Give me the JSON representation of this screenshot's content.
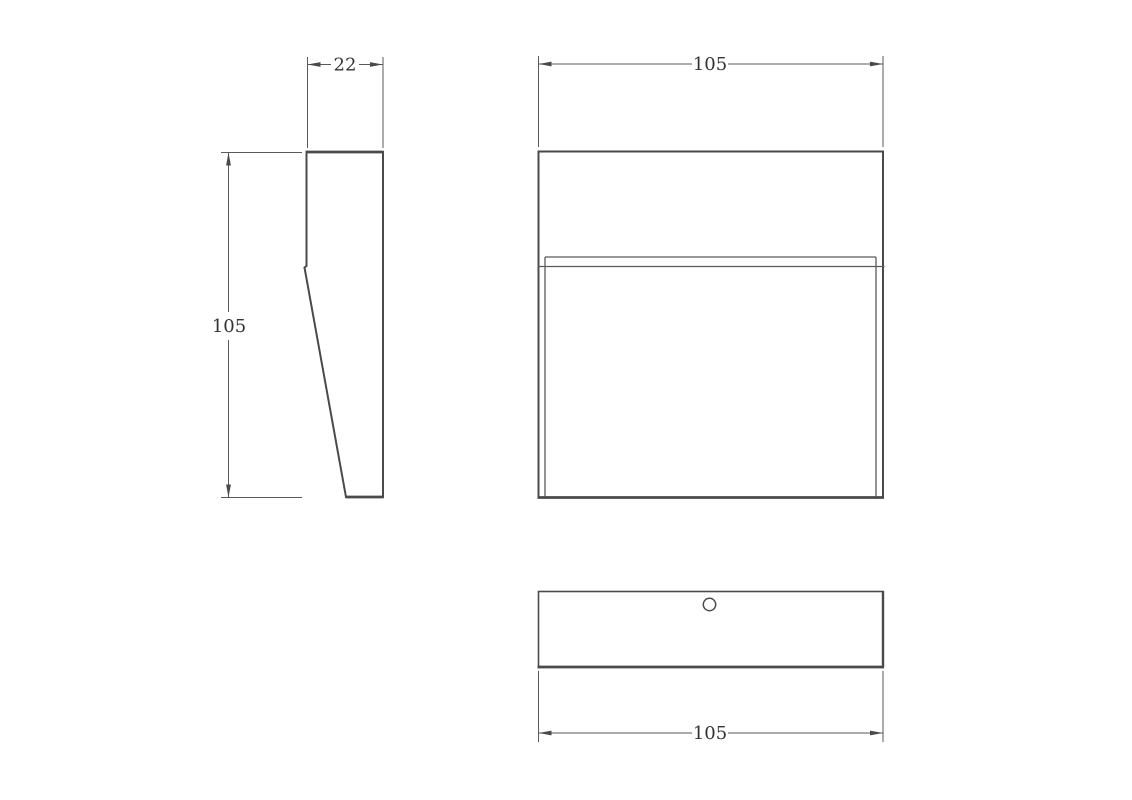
{
  "colors": {
    "background": "#ffffff",
    "object_line": "#4a4a4a",
    "dimension_line": "#5a5a5a",
    "text": "#333333"
  },
  "dimensions": {
    "side_width": "22",
    "side_height": "105",
    "front_width": "105",
    "bottom_width": "105"
  }
}
